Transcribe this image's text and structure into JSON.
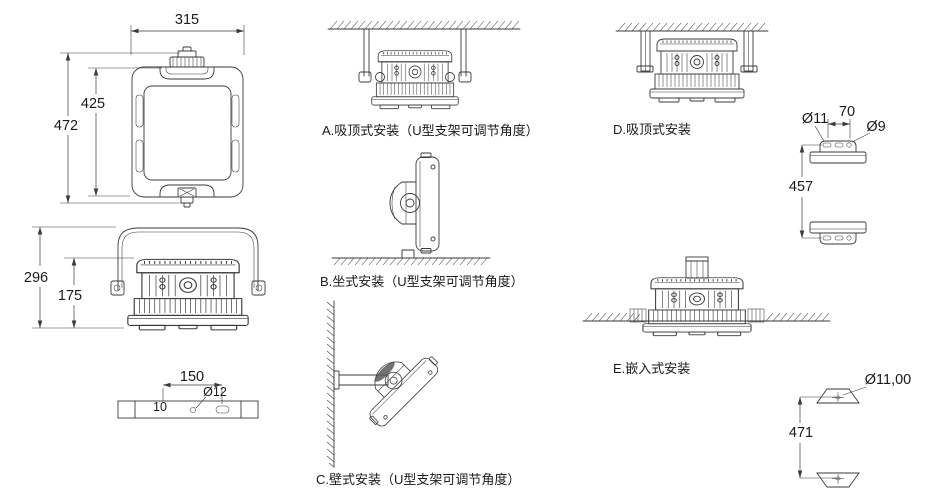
{
  "drawing": {
    "top_view": {
      "width": "315",
      "height_inner": "425",
      "height_outer": "472"
    },
    "front_view": {
      "height_total": "296",
      "height_body": "175"
    },
    "mount_bar": {
      "length": "150",
      "slot": "Ø12",
      "hole": "10"
    },
    "mounts": [
      {
        "key": "A",
        "label": "A.吸顶式安装（U型支架可调节角度）"
      },
      {
        "key": "B",
        "label": "B.坐式安装（U型支架可调节角度）"
      },
      {
        "key": "C",
        "label": "C.壁式安装（U型支架可调节角度）"
      },
      {
        "key": "D",
        "label": "D.吸顶式安装"
      },
      {
        "key": "E",
        "label": "E.嵌入式安装"
      }
    ],
    "bracket_upper": {
      "hole_left": "Ø11",
      "pitch": "70",
      "hole_right": "Ø9",
      "span": "457"
    },
    "bracket_lower": {
      "hole": "Ø11,00",
      "span": "471"
    }
  },
  "colors": {
    "line": "#3a3a3a",
    "text": "#1a1a1a",
    "background": "#ffffff"
  }
}
